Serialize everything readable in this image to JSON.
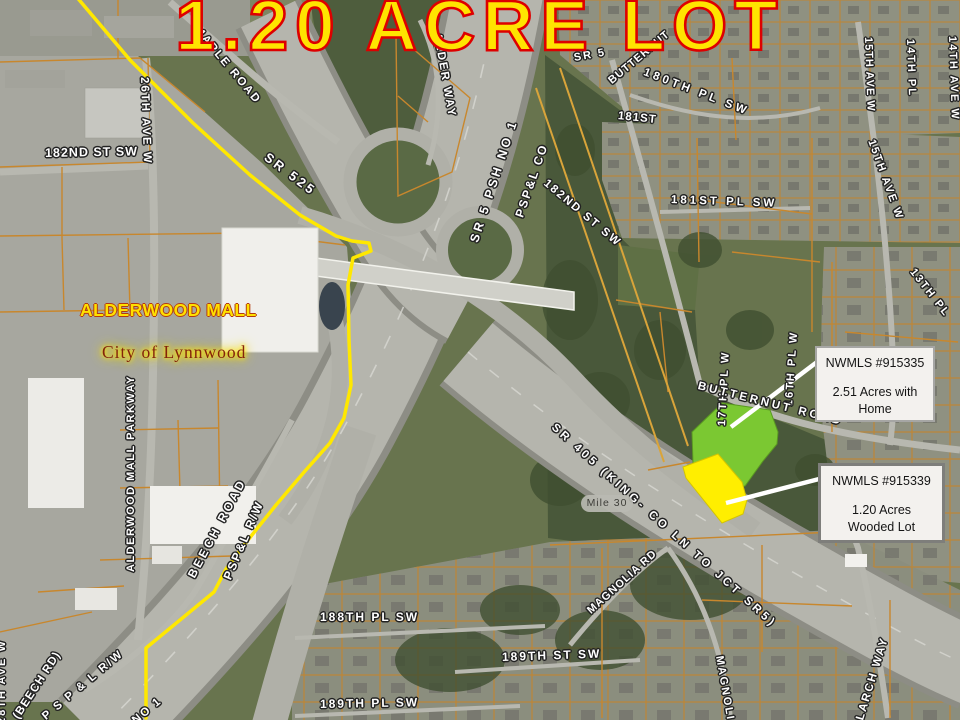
{
  "title": {
    "text": "1.20 ACRE LOT"
  },
  "callouts": [
    {
      "title": "NWMLS #915335",
      "line1": "2.51 Acres with",
      "line2": "Home"
    },
    {
      "title": "NWMLS #915339",
      "line1": "1.20 Acres",
      "line2": "Wooded Lot"
    }
  ],
  "map": {
    "place_labels": {
      "mall": "ALDERWOOD MALL",
      "city": "City of Lynnwood",
      "mile_marker": "Mile 30"
    },
    "road_labels": [
      {
        "text": "MAPLE ROAD"
      },
      {
        "text": "ALDER WAY"
      },
      {
        "text": "SR 525"
      },
      {
        "text": "SR 5 PSH NO 1"
      },
      {
        "text": "PSP&L CO"
      },
      {
        "text": "SR 5"
      },
      {
        "text": "BUTTERNUT"
      },
      {
        "text": "180TH PL SW"
      },
      {
        "text": "181ST"
      },
      {
        "text": "181ST PL SW"
      },
      {
        "text": "182ND ST SW"
      },
      {
        "text": "15TH AVE W"
      },
      {
        "text": "14TH PL"
      },
      {
        "text": "14TH AVE W"
      },
      {
        "text": "15TH AVE W"
      },
      {
        "text": "13TH PL"
      },
      {
        "text": "17TH PL W"
      },
      {
        "text": "16TH PL W"
      },
      {
        "text": "BUTTERNUT ROAD"
      },
      {
        "text": "182ND ST SW"
      },
      {
        "text": "26TH AVE W"
      },
      {
        "text": "ALDERWOOD MALL PARKWAY"
      },
      {
        "text": "BEECH ROAD"
      },
      {
        "text": "PSP&L R/W"
      },
      {
        "text": "SR 405 (KING- CO LN TO JCT SR5)"
      },
      {
        "text": "MAGNOLIA RD"
      },
      {
        "text": "MAGNOLIA"
      },
      {
        "text": "LARCH WAY"
      },
      {
        "text": "188TH PL SW"
      },
      {
        "text": "189TH ST SW"
      },
      {
        "text": "189TH PL SW"
      },
      {
        "text": "(BEECH RD)"
      },
      {
        "text": "P S P & L R/W"
      },
      {
        "text": "NO 1"
      },
      {
        "text": "28TH AVE W"
      }
    ]
  },
  "colors": {
    "title_fill": "#ffe400",
    "title_outline": "#dd0000",
    "parcel_line_orange": "#c8872d",
    "city_boundary_yellow": "#ffe800",
    "green_parcel": "#7bc832",
    "yellow_parcel": "#ffee00",
    "callout_bg": "#f3f1ee"
  }
}
